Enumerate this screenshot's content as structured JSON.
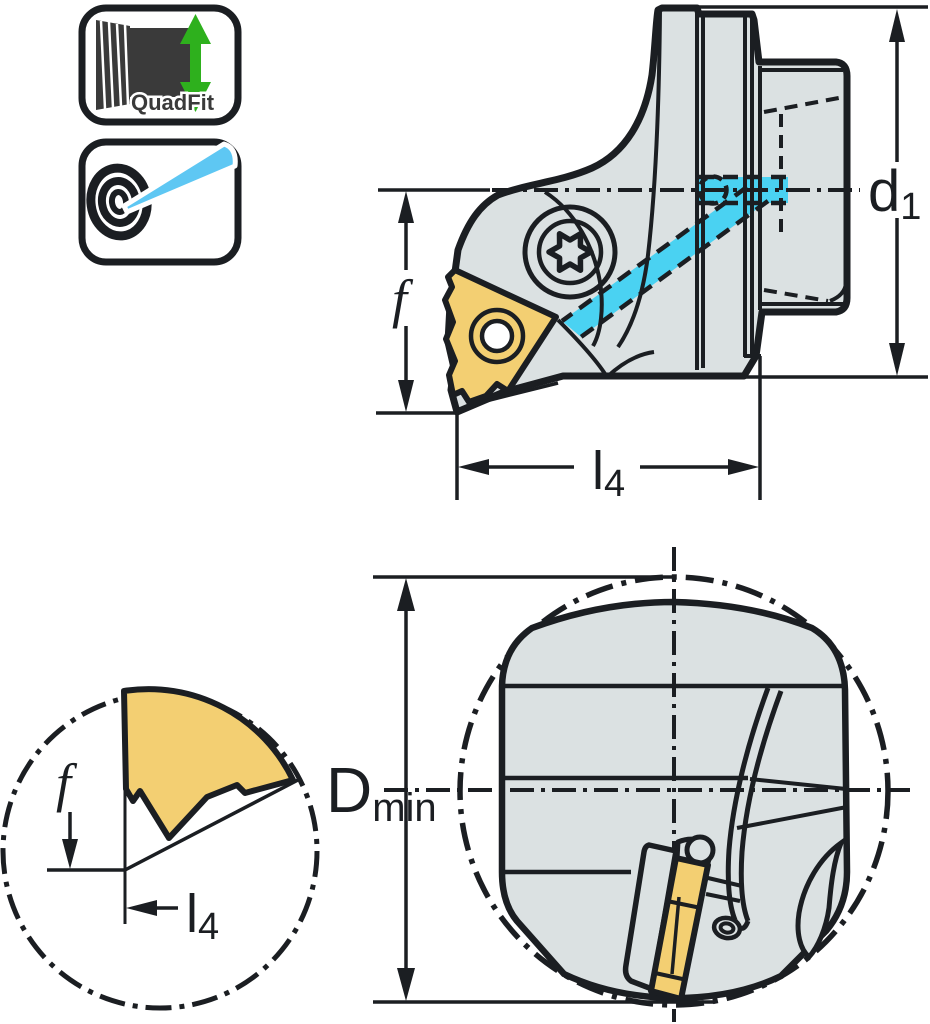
{
  "page": {
    "width": 930,
    "height": 1024,
    "background": "#ffffff"
  },
  "colors": {
    "line": "#1b1e22",
    "body": "#dbe1e2",
    "gold": "#f3cf72",
    "cyan": "#4ad2f2",
    "green": "#2eb01d",
    "blue": "#5ec7f3",
    "labelgray": "#3a3a3a"
  },
  "badges": {
    "quadfit": {
      "label": "QuadFit"
    },
    "precision": {
      "description": "bullseye with boring-bar pointer"
    }
  },
  "views": {
    "side_view": {
      "labels": {
        "d1": {
          "base": "d",
          "sub": "1"
        },
        "f": "f",
        "l4": {
          "base": "l",
          "sub": "4"
        }
      }
    },
    "detail_view": {
      "labels": {
        "f": "f",
        "l4": {
          "base": "l",
          "sub": "4"
        }
      }
    },
    "front_view": {
      "labels": {
        "dmin": {
          "base": "D",
          "sub": "min"
        }
      }
    }
  }
}
